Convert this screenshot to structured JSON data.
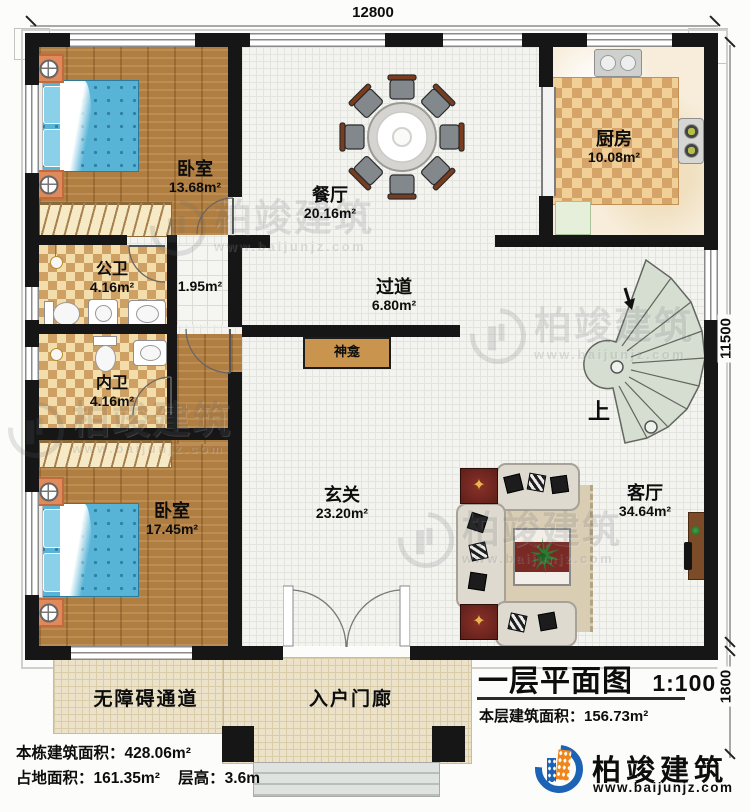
{
  "dimensions": {
    "width_top": "12800",
    "height_right": "11500",
    "porch_depth": "1800"
  },
  "rooms": {
    "bedroom1": {
      "name": "卧室",
      "area": "13.68m²"
    },
    "dining": {
      "name": "餐厅",
      "area": "20.16m²"
    },
    "kitchen": {
      "name": "厨房",
      "area": "10.08m²"
    },
    "bath_public": {
      "name": "公卫",
      "area": "4.16m²"
    },
    "hall_small": {
      "area": "1.95m²"
    },
    "bath_inner": {
      "name": "内卫",
      "area": "4.16m²"
    },
    "corridor": {
      "name": "过道",
      "area": "6.80m²"
    },
    "shrine": {
      "name": "神龛"
    },
    "bedroom2": {
      "name": "卧室",
      "area": "17.45m²"
    },
    "foyer": {
      "name": "玄关",
      "area": "23.20m²"
    },
    "living": {
      "name": "客厅",
      "area": "34.64m²"
    },
    "stairs": {
      "up_label": "上"
    },
    "ramp": {
      "name": "无障碍通道"
    },
    "porch": {
      "name": "入户门廊"
    }
  },
  "title_block": {
    "title": "一层平面图",
    "scale": "1:100",
    "floor_area": "本层建筑面积：156.73m²"
  },
  "stats": {
    "building_area": "本栋建筑面积：428.06m²",
    "footprint_area": "占地面积：161.35m²",
    "floor_height": "层高：3.6m"
  },
  "brand": {
    "name": "柏竣建筑",
    "website": "www.baijunjz.com"
  },
  "watermark": {
    "name": "柏竣建筑",
    "website": "www.baijunjz.com"
  },
  "colors": {
    "wall": "#161616",
    "wood_floor": "#b17e41",
    "brand_blue": "#1c63b6",
    "brand_orange": "#f08519"
  }
}
